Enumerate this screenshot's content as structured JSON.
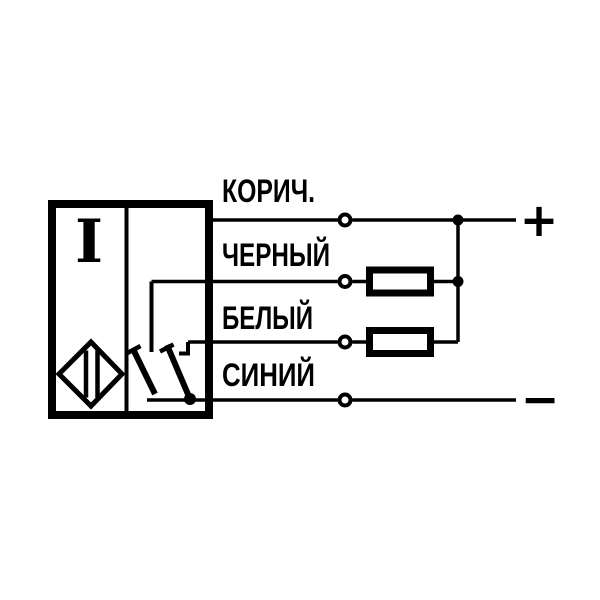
{
  "diagram": {
    "description": "sensor-wiring-connection-diagram",
    "sensor": {
      "function_symbol": "I"
    },
    "wires": [
      {
        "name": "brown",
        "label": "КОРИЧ."
      },
      {
        "name": "black",
        "label": "ЧЕРНЫЙ"
      },
      {
        "name": "white",
        "label": "БЕЛЫЙ"
      },
      {
        "name": "blue",
        "label": "СИНИЙ"
      }
    ],
    "terminals": {
      "positive": "+",
      "negative": "−"
    },
    "colors": {
      "ink": "#000000",
      "background": "#ffffff"
    }
  }
}
